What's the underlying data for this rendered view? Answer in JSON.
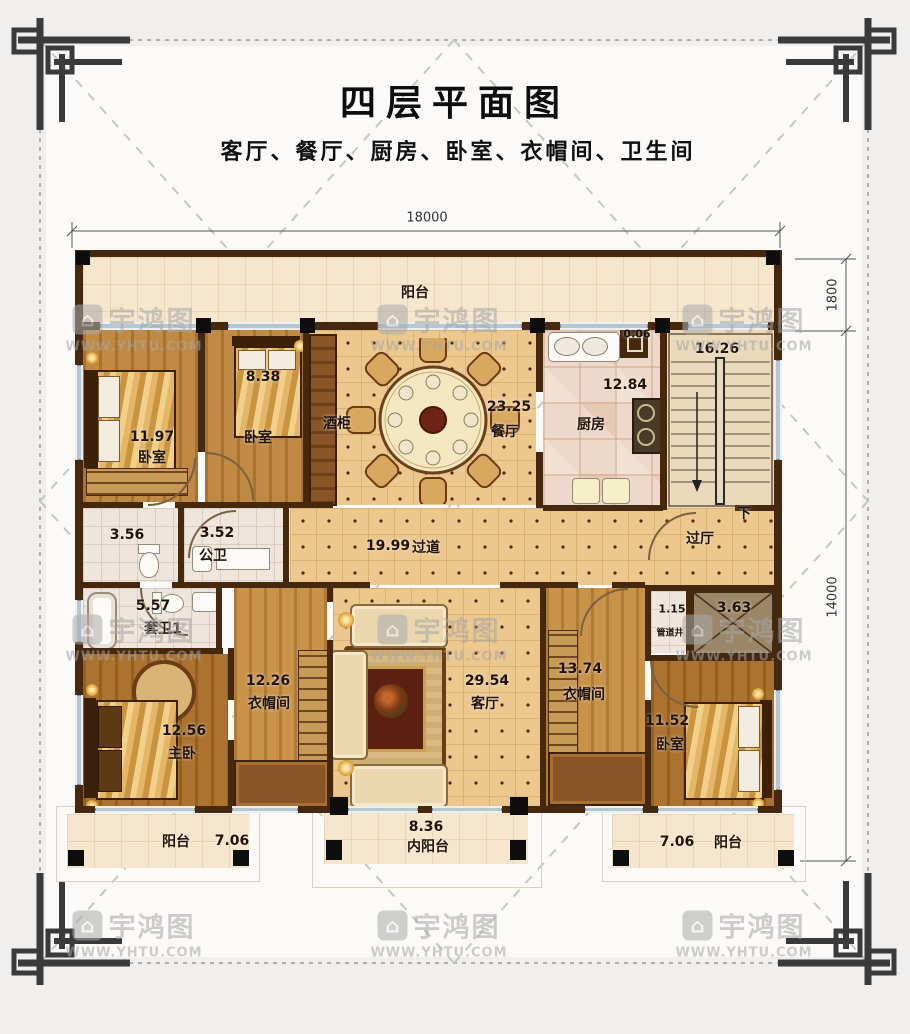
{
  "title": "四层平面图",
  "subtitle": "客厅、餐厅、厨房、卧室、衣帽间、卫生间",
  "watermark": {
    "brand": "宇鸿图",
    "url": "WWW.YHTU.COM"
  },
  "dimensions": {
    "width_top": "18000",
    "balcony_depth": "1800",
    "height_right": "14000"
  },
  "rooms": {
    "balcony_top": {
      "name": "阳台"
    },
    "bedroom_tl": {
      "name": "卧室",
      "area": "11.97"
    },
    "bedroom_t2": {
      "name": "卧室",
      "area": "8.38"
    },
    "wine_cabinet": {
      "name": "酒柜"
    },
    "dining": {
      "name": "餐厅",
      "area": "23.25"
    },
    "kitchen": {
      "name": "厨房",
      "area": "12.84"
    },
    "stairwell": {
      "area": "16.26",
      "down_label": "下"
    },
    "flue": {
      "area": "0.06"
    },
    "toilet": {
      "area": "3.56"
    },
    "public_bath": {
      "name": "公卫",
      "area": "3.52"
    },
    "corridor": {
      "name": "过道",
      "area": "19.99"
    },
    "hall": {
      "name": "过厅"
    },
    "ensuite_1": {
      "name": "套卫1",
      "area": "5.57"
    },
    "master_bedroom": {
      "name": "主卧",
      "area": "12.56"
    },
    "cloakroom_left": {
      "name": "衣帽间",
      "area": "12.26"
    },
    "living": {
      "name": "客厅",
      "area": "29.54"
    },
    "cloakroom_right": {
      "name": "衣帽间",
      "area": "13.74"
    },
    "pipe_shaft": {
      "name": "管道井",
      "area": "1.15"
    },
    "void": {
      "area": "3.63"
    },
    "bedroom_br": {
      "name": "卧室",
      "area": "11.52"
    },
    "balcony_bl": {
      "name": "阳台",
      "area": "7.06"
    },
    "balcony_inner": {
      "name": "内阳台",
      "area": "8.36"
    },
    "balcony_br": {
      "name": "阳台",
      "area": "7.06"
    }
  }
}
